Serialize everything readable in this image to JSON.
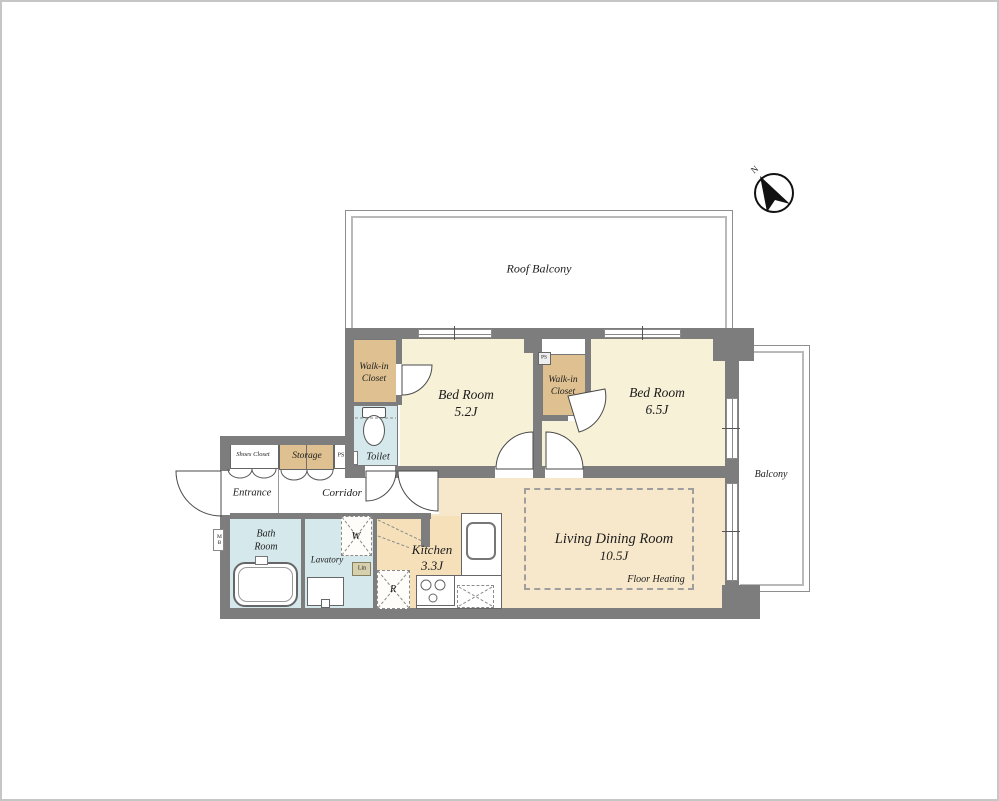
{
  "floor_plan": {
    "compass": {
      "north_label": "N"
    },
    "outdoor": {
      "roof_balcony_label": "Roof Balcony",
      "balcony_label": "Balcony"
    },
    "rooms": {
      "bedroom_1": {
        "name": "Bed Room",
        "size": "5.2J"
      },
      "bedroom_2": {
        "name": "Bed Room",
        "size": "6.5J"
      },
      "walk_in_closet_1": {
        "line1": "Walk-in",
        "line2": "Closet"
      },
      "walk_in_closet_2": {
        "line1": "Walk-in",
        "line2": "Closet"
      },
      "toilet": {
        "name": "Toilet"
      },
      "shoes_closet": {
        "name": "Shoes Closet"
      },
      "storage": {
        "name": "Storage"
      },
      "entrance": {
        "name": "Entrance"
      },
      "corridor": {
        "name": "Corridor"
      },
      "bath_room": {
        "line1": "Bath",
        "line2": "Room"
      },
      "lavatory": {
        "name": "Lavatory"
      },
      "kitchen": {
        "name": "Kitchen",
        "size": "3.3J"
      },
      "living_dining": {
        "name": "Living Dining Room",
        "size": "10.5J",
        "floor_note": "Floor Heating"
      }
    },
    "annotations": {
      "washing_machine": "W",
      "refrigerator": "R",
      "linen": "Lin",
      "pipe_space_left": "PS",
      "pipe_space_center": "PS",
      "meter_box": "MB"
    },
    "colors": {
      "wall": "#7d7d7d",
      "bedroom_fill": "#f6f1d7",
      "closet_fill": "#dfc191",
      "wet_area_fill": "#d5e9ec",
      "ldk_fill": "#f8e8cb",
      "kitchen_fill": "#f5e0ba",
      "outdoor_fill": "#ffffff"
    }
  }
}
